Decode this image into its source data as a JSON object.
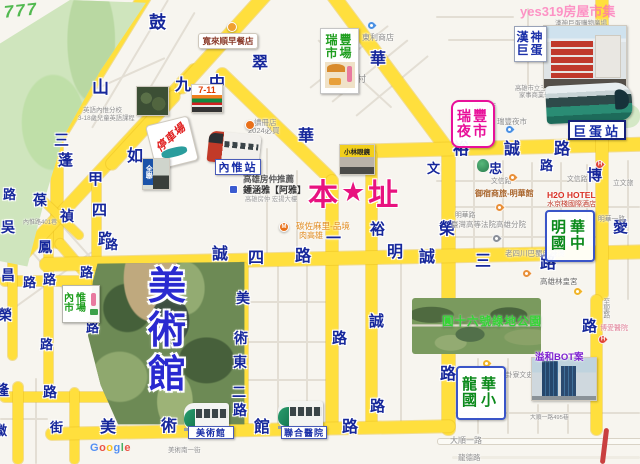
{
  "watermarks": {
    "top_left": "777",
    "top_right": "yes319房屋市集",
    "google": "Google"
  },
  "marker": {
    "char_left": "本",
    "star": "★",
    "char_right": "址"
  },
  "stations": {
    "neiwei": "內惟站",
    "dome": "巨蛋站",
    "museum": "美術館",
    "hospital": "聯合醫院"
  },
  "boxes": {
    "ruifeng_market": [
      "瑞豐",
      "市場"
    ],
    "ruifeng_night": [
      "瑞豐",
      "夜市"
    ],
    "hanshin": [
      "漢神",
      "巨蛋"
    ],
    "minghua": [
      "明華",
      "國中"
    ],
    "longhua": [
      "龍華",
      "國小"
    ],
    "neiwei_market": [
      "內惟",
      "市場"
    ]
  },
  "big_labels": {
    "museum_park": [
      "美",
      "術",
      "館"
    ],
    "park16": "圓十六號綠地公園",
    "bot": "溢和BOT案"
  },
  "tiles": {
    "seven": "7-11",
    "parking": "停車場",
    "pxmart": "全聯",
    "glasses": "小林眼鏡",
    "breakfast": "寬來順早餐店"
  },
  "road_chars": [
    {
      "t": "鼓",
      "x": 149,
      "y": 14,
      "s": 17
    },
    {
      "t": "山",
      "x": 92,
      "y": 79,
      "s": 17
    },
    {
      "t": "三",
      "x": 54,
      "y": 133,
      "s": 15
    },
    {
      "t": "蓬",
      "x": 58,
      "y": 153,
      "s": 15
    },
    {
      "t": "甲",
      "x": 88,
      "y": 172,
      "s": 15
    },
    {
      "t": "四",
      "x": 92,
      "y": 203,
      "s": 15
    },
    {
      "t": "路",
      "x": 98,
      "y": 232,
      "s": 15
    },
    {
      "t": "葆",
      "x": 33,
      "y": 193,
      "s": 14
    },
    {
      "t": "禎",
      "x": 60,
      "y": 209,
      "s": 14
    },
    {
      "t": "九",
      "x": 175,
      "y": 78,
      "s": 16
    },
    {
      "t": "如",
      "x": 127,
      "y": 149,
      "s": 16
    },
    {
      "t": "翠",
      "x": 252,
      "y": 56,
      "s": 16
    },
    {
      "t": "中",
      "x": 209,
      "y": 76,
      "s": 16
    },
    {
      "t": "華",
      "x": 298,
      "y": 129,
      "s": 16
    },
    {
      "t": "一",
      "x": 326,
      "y": 231,
      "s": 15
    },
    {
      "t": "路",
      "x": 332,
      "y": 331,
      "s": 15
    },
    {
      "t": "華",
      "x": 370,
      "y": 52,
      "s": 16
    },
    {
      "t": "榮",
      "x": 439,
      "y": 222,
      "s": 16
    },
    {
      "t": "路",
      "x": 440,
      "y": 367,
      "s": 16
    },
    {
      "t": "裕",
      "x": 453,
      "y": 142,
      "s": 16
    },
    {
      "t": "誠",
      "x": 504,
      "y": 142,
      "s": 16
    },
    {
      "t": "路",
      "x": 554,
      "y": 142,
      "s": 16
    },
    {
      "t": "裕",
      "x": 370,
      "y": 222,
      "s": 15
    },
    {
      "t": "誠",
      "x": 369,
      "y": 314,
      "s": 15
    },
    {
      "t": "路",
      "x": 370,
      "y": 399,
      "s": 15
    },
    {
      "t": "文",
      "x": 427,
      "y": 162,
      "s": 13
    },
    {
      "t": "忠",
      "x": 489,
      "y": 162,
      "s": 13
    },
    {
      "t": "路",
      "x": 540,
      "y": 159,
      "s": 13
    },
    {
      "t": "誠",
      "x": 212,
      "y": 247,
      "s": 16
    },
    {
      "t": "四",
      "x": 248,
      "y": 251,
      "s": 16
    },
    {
      "t": "路",
      "x": 295,
      "y": 249,
      "s": 16
    },
    {
      "t": "明",
      "x": 387,
      "y": 245,
      "s": 16
    },
    {
      "t": "誠",
      "x": 419,
      "y": 250,
      "s": 16
    },
    {
      "t": "三",
      "x": 475,
      "y": 254,
      "s": 16
    },
    {
      "t": "路",
      "x": 540,
      "y": 256,
      "s": 16
    },
    {
      "t": "博",
      "x": 587,
      "y": 168,
      "s": 15
    },
    {
      "t": "愛",
      "x": 613,
      "y": 220,
      "s": 15
    },
    {
      "t": "路",
      "x": 582,
      "y": 319,
      "s": 15
    },
    {
      "t": "美",
      "x": 236,
      "y": 291,
      "s": 14
    },
    {
      "t": "術",
      "x": 234,
      "y": 331,
      "s": 14
    },
    {
      "t": "東",
      "x": 233,
      "y": 355,
      "s": 14
    },
    {
      "t": "二",
      "x": 232,
      "y": 385,
      "s": 14
    },
    {
      "t": "路",
      "x": 233,
      "y": 403,
      "s": 14
    },
    {
      "t": "美",
      "x": 100,
      "y": 420,
      "s": 16
    },
    {
      "t": "術",
      "x": 161,
      "y": 419,
      "s": 16
    },
    {
      "t": "館",
      "x": 254,
      "y": 420,
      "s": 16
    },
    {
      "t": "路",
      "x": 342,
      "y": 420,
      "s": 16
    },
    {
      "t": "路",
      "x": 3,
      "y": 188,
      "s": 13
    },
    {
      "t": "吳",
      "x": 1,
      "y": 220,
      "s": 14
    },
    {
      "t": "鳳",
      "x": 38,
      "y": 240,
      "s": 14
    },
    {
      "t": "昌",
      "x": 1,
      "y": 268,
      "s": 14
    },
    {
      "t": "路",
      "x": 23,
      "y": 276,
      "s": 13
    },
    {
      "t": "路",
      "x": 43,
      "y": 273,
      "s": 13
    },
    {
      "t": "路",
      "x": 80,
      "y": 266,
      "s": 13
    },
    {
      "t": "路",
      "x": 105,
      "y": 238,
      "s": 13
    },
    {
      "t": "榮",
      "x": -2,
      "y": 308,
      "s": 14
    },
    {
      "t": "路",
      "x": 40,
      "y": 338,
      "s": 13
    },
    {
      "t": "路",
      "x": 86,
      "y": 321,
      "s": 13
    },
    {
      "t": "隆",
      "x": -5,
      "y": 383,
      "s": 14
    },
    {
      "t": "路",
      "x": 43,
      "y": 385,
      "s": 14
    },
    {
      "t": "徽",
      "x": -6,
      "y": 424,
      "s": 13
    },
    {
      "t": "街",
      "x": 50,
      "y": 421,
      "s": 13
    }
  ],
  "labels": [
    {
      "t": "東利商店",
      "x": 362,
      "y": 33,
      "s": 8
    },
    {
      "t": "華豐新村",
      "x": 330,
      "y": 74,
      "s": 9
    },
    {
      "t": "漢神巨蛋購物廣場",
      "x": 555,
      "y": 20,
      "s": 6.5
    },
    {
      "t": "新庄仔路",
      "x": 584,
      "y": 34,
      "s": 6.8,
      "c": "#93a3b3"
    },
    {
      "t": "英語內惟分校",
      "x": 83,
      "y": 107,
      "s": 6.5
    },
    {
      "t": "3-18歲兒童英語課程",
      "x": 78,
      "y": 115,
      "s": 6.3
    },
    {
      "t": "讀冊店",
      "x": 254,
      "y": 119,
      "s": 7.5
    },
    {
      "t": "2024必買",
      "x": 248,
      "y": 127,
      "s": 7.5
    },
    {
      "t": "內惟路401巷",
      "x": 23,
      "y": 220,
      "s": 6
    },
    {
      "t": "高雄房仲推薦",
      "x": 243,
      "y": 175,
      "s": 8.5,
      "c": "#555",
      "b": 1
    },
    {
      "t": "鍾涵雅【阿雅】",
      "x": 243,
      "y": 185,
      "s": 9,
      "c": "#333",
      "b": 1
    },
    {
      "t": "高雄房仲 宏揚大樓",
      "x": 245,
      "y": 196,
      "s": 6.3,
      "c": "#9a9a9a"
    },
    {
      "t": "碳佐麻里-品境",
      "x": 296,
      "y": 222,
      "s": 8.5,
      "c": "#e08a1e"
    },
    {
      "t": "肉高雄",
      "x": 299,
      "y": 231,
      "s": 8,
      "c": "#e08a1e"
    },
    {
      "t": "山東門店",
      "x": 466,
      "y": 103,
      "s": 7.5
    },
    {
      "t": "瑞豐夜市",
      "x": 497,
      "y": 118,
      "s": 7.5
    },
    {
      "t": "高雄市立三民家商",
      "x": 515,
      "y": 85,
      "s": 6.3
    },
    {
      "t": "家事商業學校",
      "x": 519,
      "y": 92,
      "s": 6.3
    },
    {
      "t": "文信路",
      "x": 491,
      "y": 178,
      "s": 6.8
    },
    {
      "t": "文信路",
      "x": 567,
      "y": 176,
      "s": 6.8
    },
    {
      "t": "明華路",
      "x": 455,
      "y": 212,
      "s": 6.8
    },
    {
      "t": "明華一路",
      "x": 598,
      "y": 216,
      "s": 6.8
    },
    {
      "t": "御宿商旅-明華館",
      "x": 475,
      "y": 189,
      "s": 8,
      "c": "#a8642a",
      "b": 1
    },
    {
      "t": "H2O HOTEL",
      "x": 547,
      "y": 191,
      "s": 8.5,
      "c": "#d93025",
      "b": 1
    },
    {
      "t": "水京棧國際酒店",
      "x": 547,
      "y": 201,
      "s": 7,
      "c": "#c0392b"
    },
    {
      "t": "臺灣高等法院高雄分院",
      "x": 451,
      "y": 221,
      "s": 7.5
    },
    {
      "t": "老四川巴蜀麻辣燙",
      "x": 505,
      "y": 250,
      "s": 7.5
    },
    {
      "t": "高雄林皇宮",
      "x": 540,
      "y": 278,
      "s": 7.5,
      "c": "#666"
    },
    {
      "t": "博愛醫院",
      "x": 600,
      "y": 325,
      "s": 7,
      "c": "#e08098"
    },
    {
      "t": "至聖路",
      "x": 601,
      "y": 298,
      "s": 6.8,
      "v": 1
    },
    {
      "t": "八卦寮文史館",
      "x": 499,
      "y": 372,
      "s": 6.8
    },
    {
      "t": "大順一路",
      "x": 450,
      "y": 436,
      "s": 8
    },
    {
      "t": "龍德路",
      "x": 458,
      "y": 454,
      "s": 7.5
    },
    {
      "t": "大順一路495巷",
      "x": 530,
      "y": 415,
      "s": 5.8
    },
    {
      "t": "美術南一街",
      "x": 168,
      "y": 447,
      "s": 6.5
    },
    {
      "t": "立文旅",
      "x": 613,
      "y": 180,
      "s": 6.8
    }
  ],
  "pins": [
    {
      "k": "pin",
      "c": "#4a90e2",
      "x": 367,
      "y": 21
    },
    {
      "k": "pin",
      "c": "#4a90e2",
      "x": 505,
      "y": 125
    },
    {
      "k": "pin",
      "c": "#8a8f98",
      "x": 492,
      "y": 234
    },
    {
      "k": "pin",
      "c": "#e8903a",
      "x": 508,
      "y": 173
    },
    {
      "k": "pin",
      "c": "#e8903a",
      "x": 495,
      "y": 203
    },
    {
      "k": "pin",
      "c": "#e8903a",
      "x": 522,
      "y": 269
    },
    {
      "k": "pin",
      "c": "#f0b429",
      "x": 573,
      "y": 287
    },
    {
      "k": "pin",
      "c": "#f0b429",
      "x": 482,
      "y": 359
    },
    {
      "k": "pin",
      "c": "#e04438",
      "x": 595,
      "y": 160,
      "g": "H"
    },
    {
      "k": "pin",
      "c": "#e04438",
      "x": 598,
      "y": 335,
      "g": "H"
    },
    {
      "k": "dot",
      "c": "#e8701a",
      "x": 279,
      "y": 222,
      "g": "M"
    },
    {
      "k": "dot",
      "c": "#f0a030",
      "x": 227,
      "y": 22,
      "g": ""
    },
    {
      "k": "dot",
      "c": "#e8701a",
      "x": 245,
      "y": 120,
      "g": ""
    },
    {
      "k": "sq",
      "c": "#3b5bd0",
      "x": 229,
      "y": 185
    },
    {
      "k": "tree",
      "c": "#3a9d5f",
      "x": 477,
      "y": 159
    }
  ]
}
